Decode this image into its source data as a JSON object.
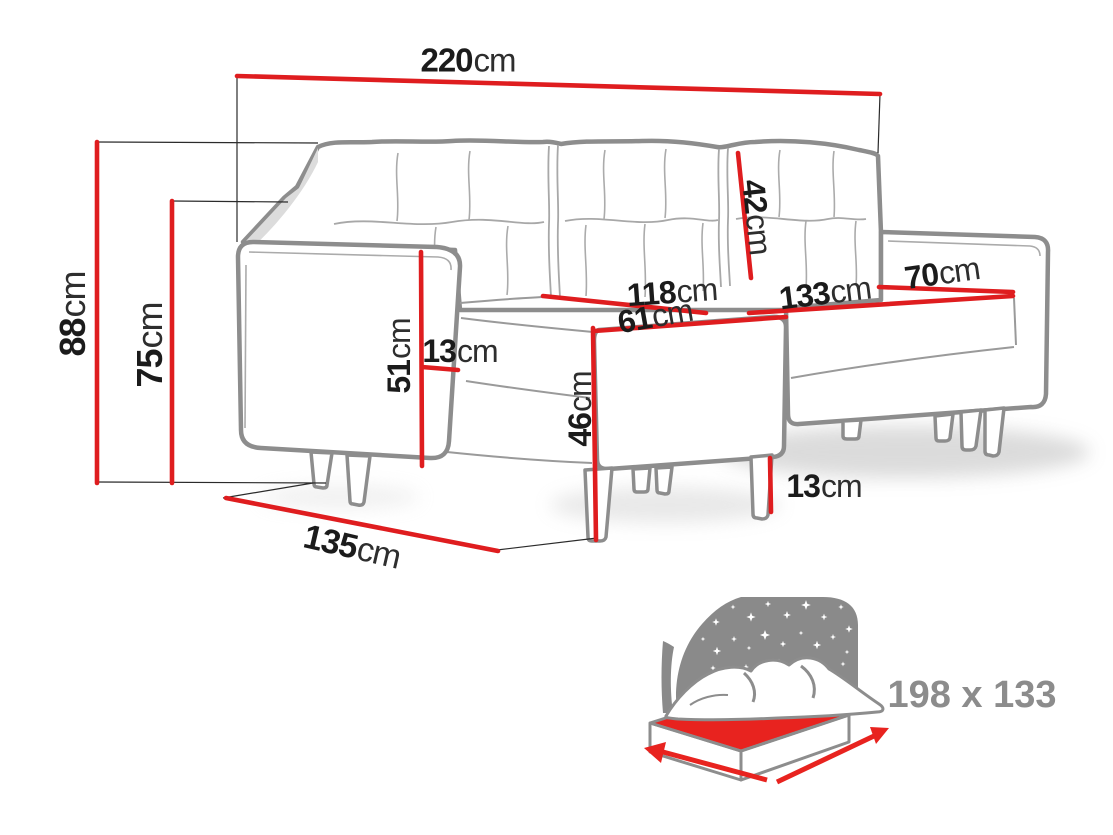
{
  "diagram": {
    "title": "sofa-bed-dimension-diagram",
    "dimensions": {
      "total_width": {
        "value": "220",
        "unit": "cm"
      },
      "total_height": {
        "value": "88",
        "unit": "cm"
      },
      "frame_height": {
        "value": "75",
        "unit": "cm"
      },
      "backrest_cushion_height": {
        "value": "42",
        "unit": "cm"
      },
      "seat_length_left": {
        "value": "118",
        "unit": "cm"
      },
      "chaise_seat_width": {
        "value": "61",
        "unit": "cm"
      },
      "seat_length_right": {
        "value": "133",
        "unit": "cm"
      },
      "seat_depth": {
        "value": "70",
        "unit": "cm"
      },
      "armrest_height": {
        "value": "51",
        "unit": "cm"
      },
      "armrest_width": {
        "value": "13",
        "unit": "cm"
      },
      "chaise_front_height": {
        "value": "46",
        "unit": "cm"
      },
      "leg_height": {
        "value": "13",
        "unit": "cm"
      },
      "total_depth": {
        "value": "135",
        "unit": "cm"
      }
    },
    "sleeping_area_label": "198 x 133",
    "icons": {
      "sleeping_function": "bed-moon-stars-icon"
    },
    "colors": {
      "dimension_red": "#df1d1f",
      "icon_red": "#e8231f",
      "outline_gray": "#8d8d8d",
      "icon_gray": "#8a8a8a",
      "label_gray": "#8c8c8c",
      "text_dark": "#1b1b1b"
    }
  }
}
